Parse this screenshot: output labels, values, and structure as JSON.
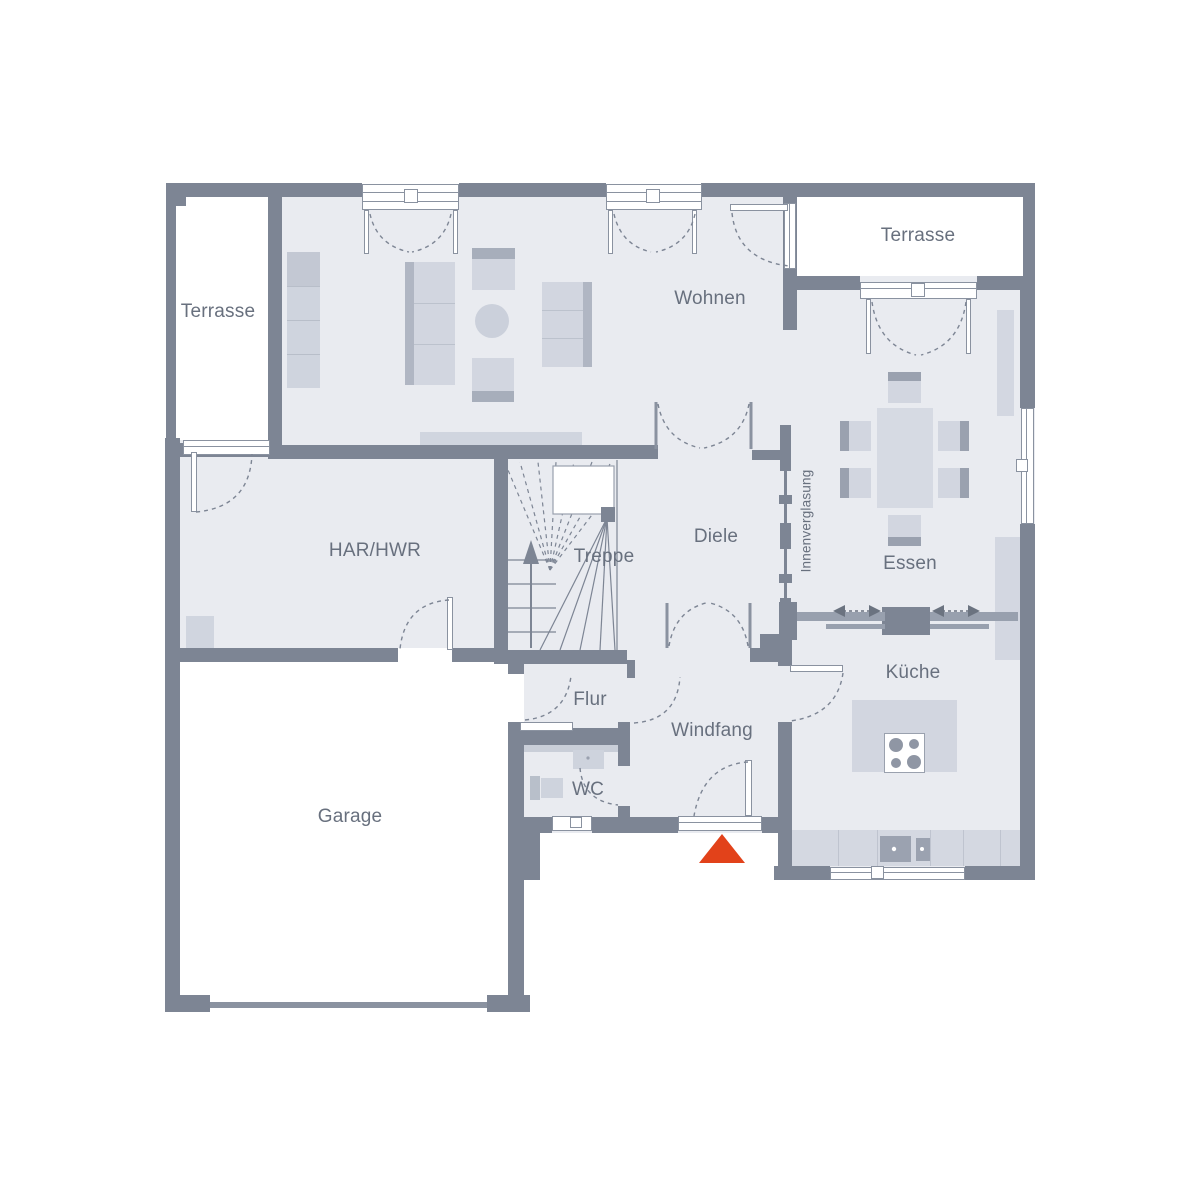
{
  "plan": {
    "type": "floor-plan",
    "rooms": {
      "terrasse_left": "Terrasse",
      "wohnen": "Wohnen",
      "terrasse_right": "Terrasse",
      "har_hwr": "HAR/HWR",
      "treppe": "Treppe",
      "diele": "Diele",
      "innenverglasung": "Innenverglasung",
      "essen": "Essen",
      "flur": "Flur",
      "windfang": "Windfang",
      "wc": "WC",
      "kueche": "Küche",
      "garage": "Garage"
    },
    "colors": {
      "wall": "#7d8594",
      "floor": "#e9ebf0",
      "furniture": "#d2d6e0",
      "furniture_dark": "#a7aebb",
      "label_text": "#68707e",
      "entrance_marker": "#e2421a",
      "background": "#ffffff"
    },
    "markers": {
      "entrance_triangle": "main-entrance"
    }
  }
}
